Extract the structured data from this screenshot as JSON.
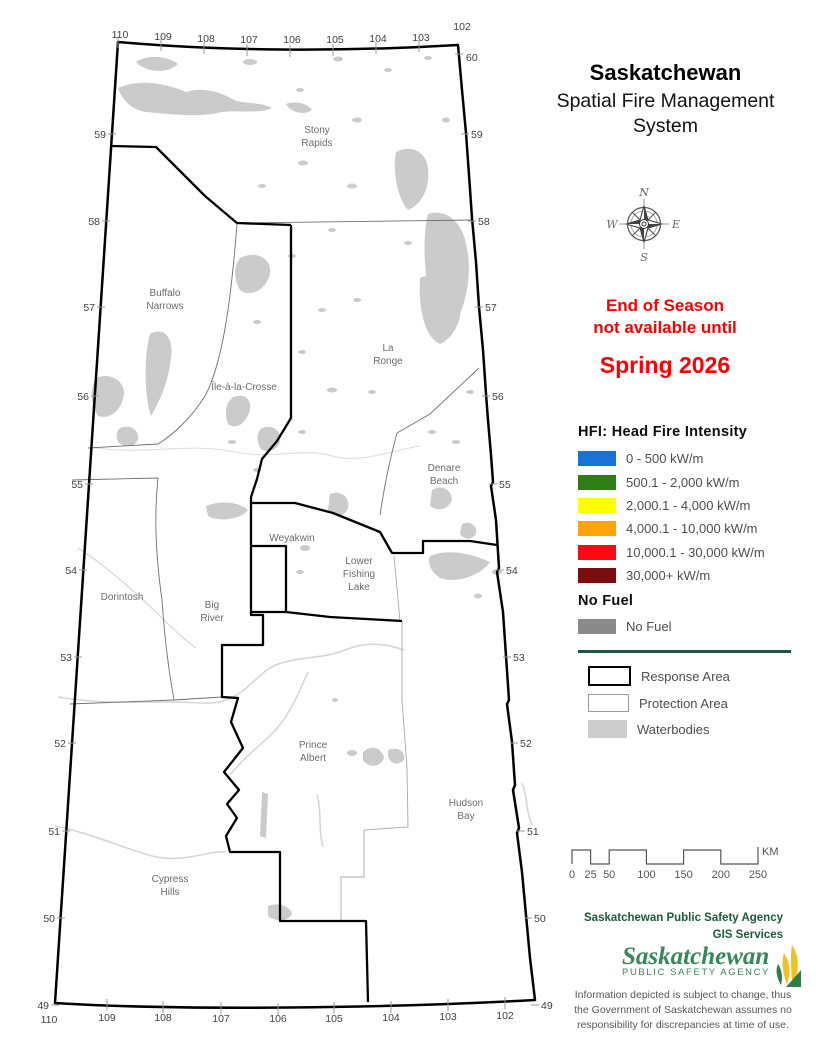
{
  "title": {
    "line1": "Saskatchewan",
    "line2": "Spatial Fire Management",
    "line3": "System"
  },
  "compass": {
    "n": "N",
    "e": "E",
    "s": "S",
    "w": "W"
  },
  "notice": {
    "line1": "End of Season",
    "line2": "not available until",
    "line3": "Spring 2026"
  },
  "hfi_legend": {
    "header": "HFI: Head Fire Intensity",
    "items": [
      {
        "color": "#1a73d4",
        "label": "0 - 500 kW/m"
      },
      {
        "color": "#2e7d15",
        "label": "500.1 - 2,000 kW/m"
      },
      {
        "color": "#ffff00",
        "label": "2,000.1 - 4,000 kW/m"
      },
      {
        "color": "#ffa40a",
        "label": "4,000.1 - 10,000 kW/m"
      },
      {
        "color": "#fa0a14",
        "label": "10,000.1 - 30,000 kW/m"
      },
      {
        "color": "#7c0d0e",
        "label": "30,000+ kW/m"
      }
    ],
    "no_fuel_header": "No Fuel",
    "no_fuel": {
      "color": "#8a8a8a",
      "label": "No Fuel"
    }
  },
  "area_legend": {
    "response": "Response Area",
    "protection": "Protection Area",
    "waterbodies": "Waterbodies"
  },
  "scale_bar": {
    "ticks": [
      0,
      25,
      50,
      100,
      150,
      200,
      250
    ],
    "unit": "KM"
  },
  "credits": {
    "org": "Saskatchewan Public Safety Agency",
    "dept": "GIS  Services",
    "logo_name": "Saskatchewan",
    "logo_sub": "PUBLIC SAFETY AGENCY",
    "disclaimer1": "Information depicted is subject to change, thus",
    "disclaimer2": "the Government of Saskatchewan assumes no",
    "disclaimer3": "responsibility for discrepancies at time of use."
  },
  "map": {
    "places": [
      {
        "x": 317,
        "y": 133,
        "lines": [
          "Stony",
          "Rapids"
        ]
      },
      {
        "x": 165,
        "y": 296,
        "lines": [
          "Buffalo",
          "Narrows"
        ]
      },
      {
        "x": 244,
        "y": 390,
        "lines": [
          "Île-à-la-Crosse"
        ]
      },
      {
        "x": 388,
        "y": 351,
        "lines": [
          "La",
          "Ronge"
        ]
      },
      {
        "x": 444,
        "y": 471,
        "lines": [
          "Denare",
          "Beach"
        ]
      },
      {
        "x": 292,
        "y": 541,
        "lines": [
          "Weyakwin"
        ]
      },
      {
        "x": 359,
        "y": 564,
        "lines": [
          "Lower",
          "Fishing",
          "Lake"
        ]
      },
      {
        "x": 122,
        "y": 600,
        "lines": [
          "Dorintosh"
        ]
      },
      {
        "x": 212,
        "y": 608,
        "lines": [
          "Big",
          "River"
        ]
      },
      {
        "x": 313,
        "y": 748,
        "lines": [
          "Prince",
          "Albert"
        ]
      },
      {
        "x": 466,
        "y": 806,
        "lines": [
          "Hudson",
          "Bay"
        ]
      },
      {
        "x": 170,
        "y": 882,
        "lines": [
          "Cypress",
          "Hills"
        ]
      }
    ],
    "lat_left": [
      {
        "v": "59",
        "x": 106,
        "y": 134
      },
      {
        "v": "58",
        "x": 100,
        "y": 221
      },
      {
        "v": "57",
        "x": 95,
        "y": 307
      },
      {
        "v": "56",
        "x": 89,
        "y": 396
      },
      {
        "v": "55",
        "x": 83,
        "y": 484
      },
      {
        "v": "54",
        "x": 77,
        "y": 570
      },
      {
        "v": "53",
        "x": 72,
        "y": 657
      },
      {
        "v": "52",
        "x": 66,
        "y": 743
      },
      {
        "v": "51",
        "x": 60,
        "y": 831
      },
      {
        "v": "50",
        "x": 55,
        "y": 918
      },
      {
        "v": "49",
        "x": 49,
        "y": 1005
      }
    ],
    "lat_right": [
      {
        "v": "60",
        "x": 466,
        "y": 57
      },
      {
        "v": "59",
        "x": 471,
        "y": 134
      },
      {
        "v": "58",
        "x": 478,
        "y": 221
      },
      {
        "v": "57",
        "x": 485,
        "y": 307
      },
      {
        "v": "56",
        "x": 492,
        "y": 396
      },
      {
        "v": "55",
        "x": 499,
        "y": 484
      },
      {
        "v": "54",
        "x": 506,
        "y": 570
      },
      {
        "v": "53",
        "x": 513,
        "y": 657
      },
      {
        "v": "52",
        "x": 520,
        "y": 743
      },
      {
        "v": "51",
        "x": 527,
        "y": 831
      },
      {
        "v": "50",
        "x": 534,
        "y": 918
      },
      {
        "v": "49",
        "x": 541,
        "y": 1005
      }
    ],
    "lon_top": [
      {
        "v": "110",
        "x": 120,
        "y": 38
      },
      {
        "v": "109",
        "x": 163,
        "y": 40
      },
      {
        "v": "108",
        "x": 206,
        "y": 42
      },
      {
        "v": "107",
        "x": 249,
        "y": 43
      },
      {
        "v": "106",
        "x": 292,
        "y": 43
      },
      {
        "v": "105",
        "x": 335,
        "y": 43
      },
      {
        "v": "104",
        "x": 378,
        "y": 42
      },
      {
        "v": "103",
        "x": 421,
        "y": 41
      },
      {
        "v": "102",
        "x": 462,
        "y": 30
      }
    ],
    "lon_bottom": [
      {
        "v": "110",
        "x": 49,
        "y": 1023
      },
      {
        "v": "109",
        "x": 107,
        "y": 1021
      },
      {
        "v": "108",
        "x": 163,
        "y": 1021
      },
      {
        "v": "107",
        "x": 221,
        "y": 1022
      },
      {
        "v": "106",
        "x": 278,
        "y": 1022
      },
      {
        "v": "105",
        "x": 334,
        "y": 1022
      },
      {
        "v": "104",
        "x": 391,
        "y": 1021
      },
      {
        "v": "103",
        "x": 448,
        "y": 1020
      },
      {
        "v": "102",
        "x": 505,
        "y": 1019
      }
    ]
  }
}
